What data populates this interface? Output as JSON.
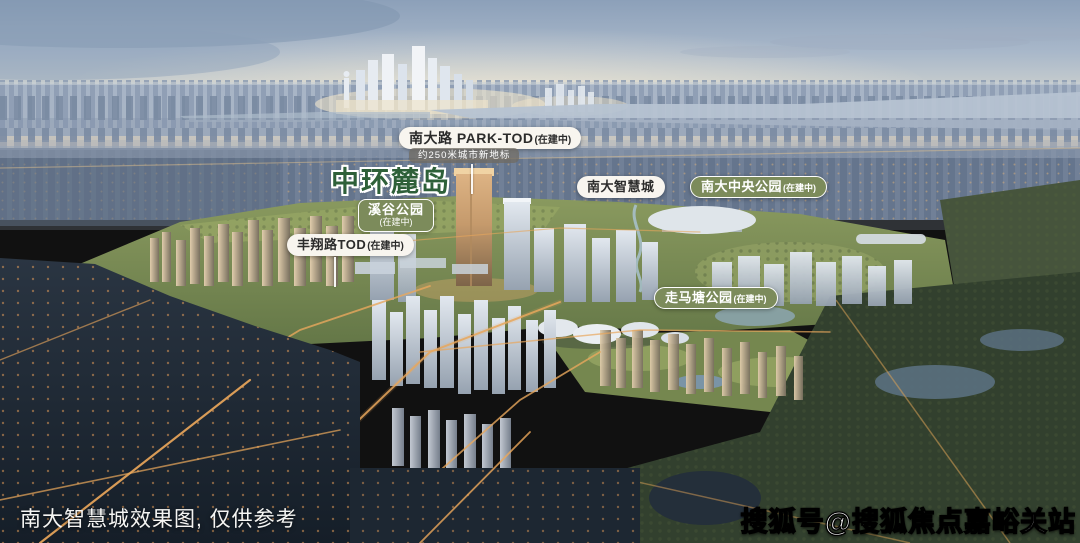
{
  "scene": {
    "caption": "南大智慧城效果图, 仅供参考",
    "watermark": "搜狐号@搜狐焦点嘉峪关站"
  },
  "labels": {
    "park_tod": {
      "title": "南大路 PARK-TOD",
      "status": "(在建中)",
      "subtitle": "约250米城市新地标"
    },
    "zhonghuan_ludao": {
      "title": "中环麓岛"
    },
    "xigu_park": {
      "title": "溪谷公园",
      "status": "(在建中)"
    },
    "fengxiang_tod": {
      "title": "丰翔路TOD",
      "status": "(在建中)"
    },
    "nanda_smart_city": {
      "title": "南大智慧城"
    },
    "nanda_central_park": {
      "title": "南大中央公园",
      "status": "(在建中)"
    },
    "zoumatang_park": {
      "title": "走马塘公园",
      "status": "(在建中)"
    }
  },
  "colors": {
    "badge_green": "#7C8B5B",
    "badge_white": "#F8F5EF",
    "badge_text_dark": "#2B2B2B",
    "headline_green": "#2E6039",
    "sky_top": "#8CA0B9",
    "horizon_cream": "#EBDFC8",
    "road_light": "#E8A75C"
  }
}
